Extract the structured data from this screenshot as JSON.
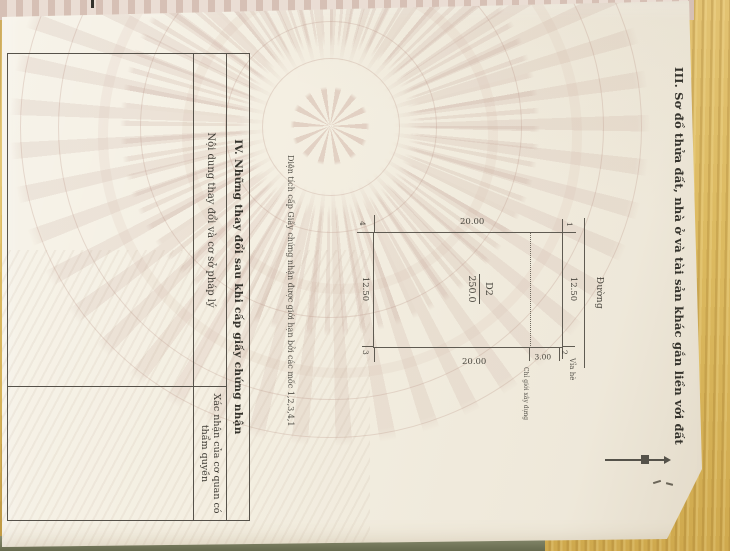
{
  "document": {
    "section_iii": {
      "heading": "III. Sơ đồ thửa đất, nhà ở và tài sản khác gắn liền với đất"
    },
    "plot_diagram": {
      "road_label": "Đường",
      "sidewalk_label": "Vỉa hè",
      "building_line_label": "Chỉ giới xây dựng",
      "setback_dimension": "3.00",
      "parcel_id": "D2",
      "parcel_area": "250.0",
      "top_dimension": "12.50",
      "bottom_dimension": "12.50",
      "left_dimension": "20.00",
      "right_dimension": "20.00",
      "corner_1": "1",
      "corner_2": "2",
      "corner_3": "3",
      "corner_4": "4",
      "note": "Diện tích cấp Giấy chứng nhận được giới hạn bởi các mốc 1,2,3,4,1"
    },
    "section_iv": {
      "heading": "IV. Những thay đổi sau khi cấp giấy chứng nhận",
      "column_1_header": "Nội dung thay đổi và cơ sở pháp lý",
      "column_2_header": "Xác nhận của cơ quan có thẩm quyền"
    }
  },
  "colors": {
    "wood": "#dcba60",
    "paper": "#f4efe2",
    "watermark": "#e2d1c8",
    "ink": "#3f3c35",
    "line": "#5f5b52",
    "table_surface_strip": "#777a5e",
    "page_edge_band": "#e7d9ce"
  }
}
